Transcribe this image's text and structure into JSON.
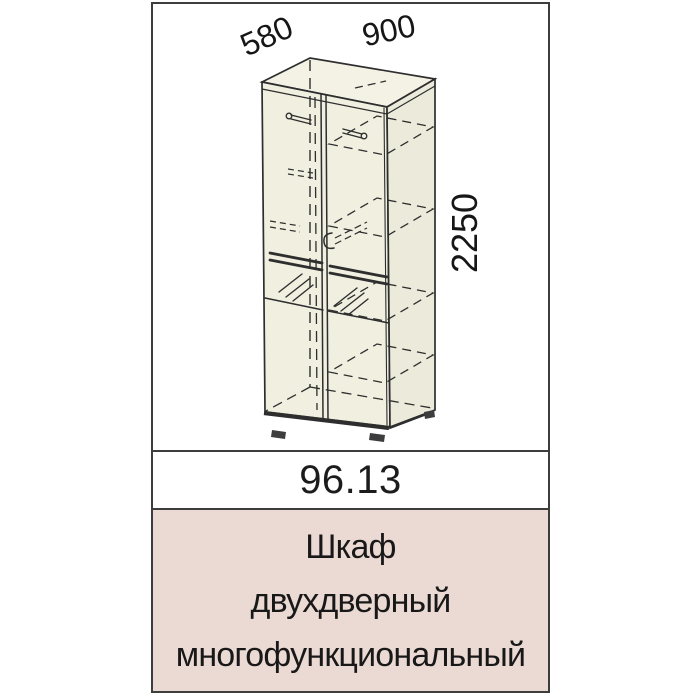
{
  "page": {
    "background_color": "#ffffff"
  },
  "card": {
    "border_color": "#3d3d3d",
    "drawing": {
      "panel_background": "#ffffff",
      "line_color": "#2e2e2e",
      "cabinet_fill": "#f0efe0",
      "dimensions": {
        "depth": "580",
        "width": "900",
        "height": "2250"
      }
    },
    "model": {
      "code": "96.13"
    },
    "label": {
      "background_color": "#ebd9d3",
      "lines": [
        "Шкаф",
        "двухдверный",
        "многофункциональный"
      ]
    }
  }
}
